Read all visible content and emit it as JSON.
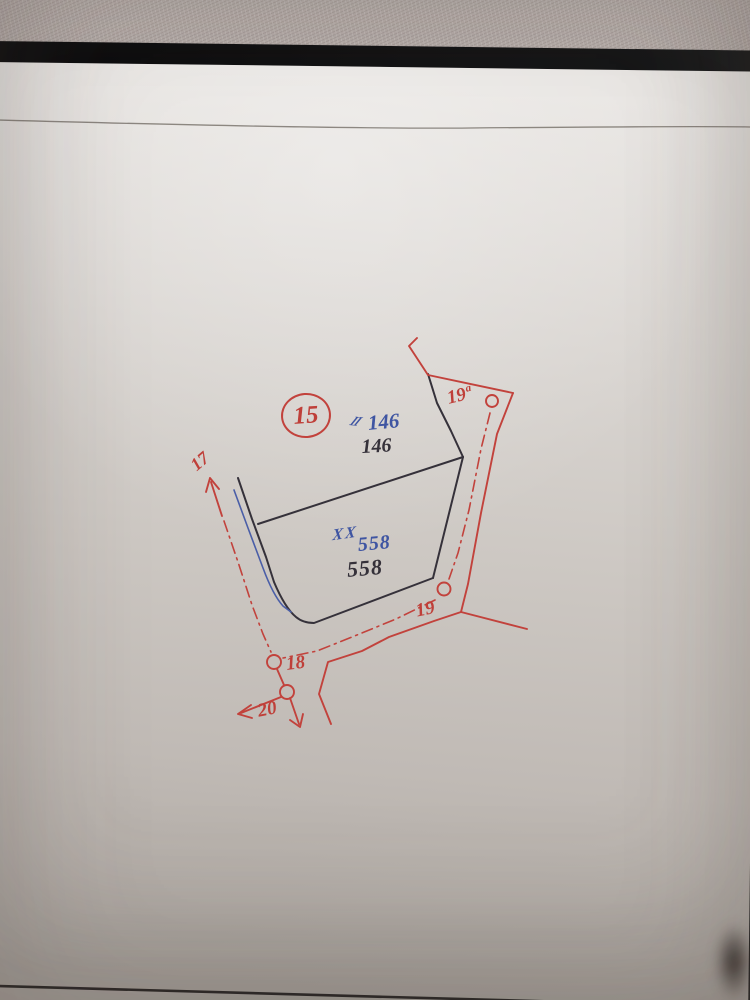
{
  "photo": {
    "scene": "Hand-drawn land survey sketch in red, blue and black ink on paper, photographed on a carpet with a black folder edge at top",
    "colors": {
      "red_ink": "#c2423c",
      "blue_ink": "#3f55a2",
      "black_ink": "#35313a",
      "paper_light": "#e8e5e2",
      "paper_dark": "#aba59f",
      "carpet": "#b5aca8"
    }
  },
  "sketch": {
    "sheet_circle_label": "15",
    "parcels": [
      {
        "position": "upper",
        "mark": "II",
        "blue_number": "146",
        "black_number": "146"
      },
      {
        "position": "lower",
        "mark": "XX",
        "blue_number": "558",
        "black_number": "558"
      }
    ],
    "survey_points": {
      "p17": {
        "label": "17"
      },
      "p18": {
        "label": "18"
      },
      "p19": {
        "label": "19"
      },
      "p19a": {
        "label": "19",
        "sup": "a"
      },
      "p20": {
        "label": "20"
      }
    }
  }
}
